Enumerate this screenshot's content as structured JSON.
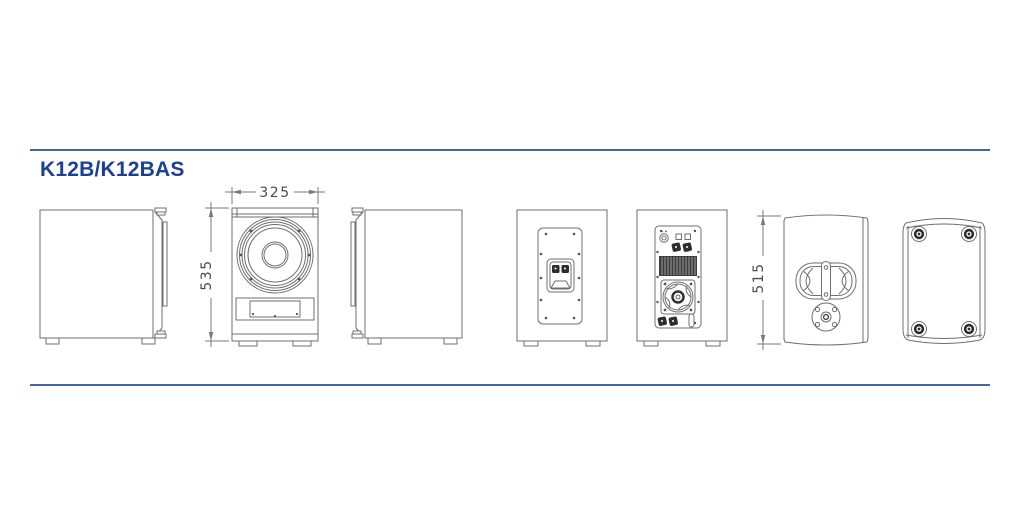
{
  "title": "K12B/K12BAS",
  "dims": {
    "front_width": "325",
    "front_height": "535",
    "side_height": "515"
  },
  "colors": {
    "accent_line": "#44699e",
    "title": "#1a3f94",
    "line": "#6f6f6f",
    "dark": "#2e2e2e",
    "dim_text": "#4a4a4a"
  }
}
